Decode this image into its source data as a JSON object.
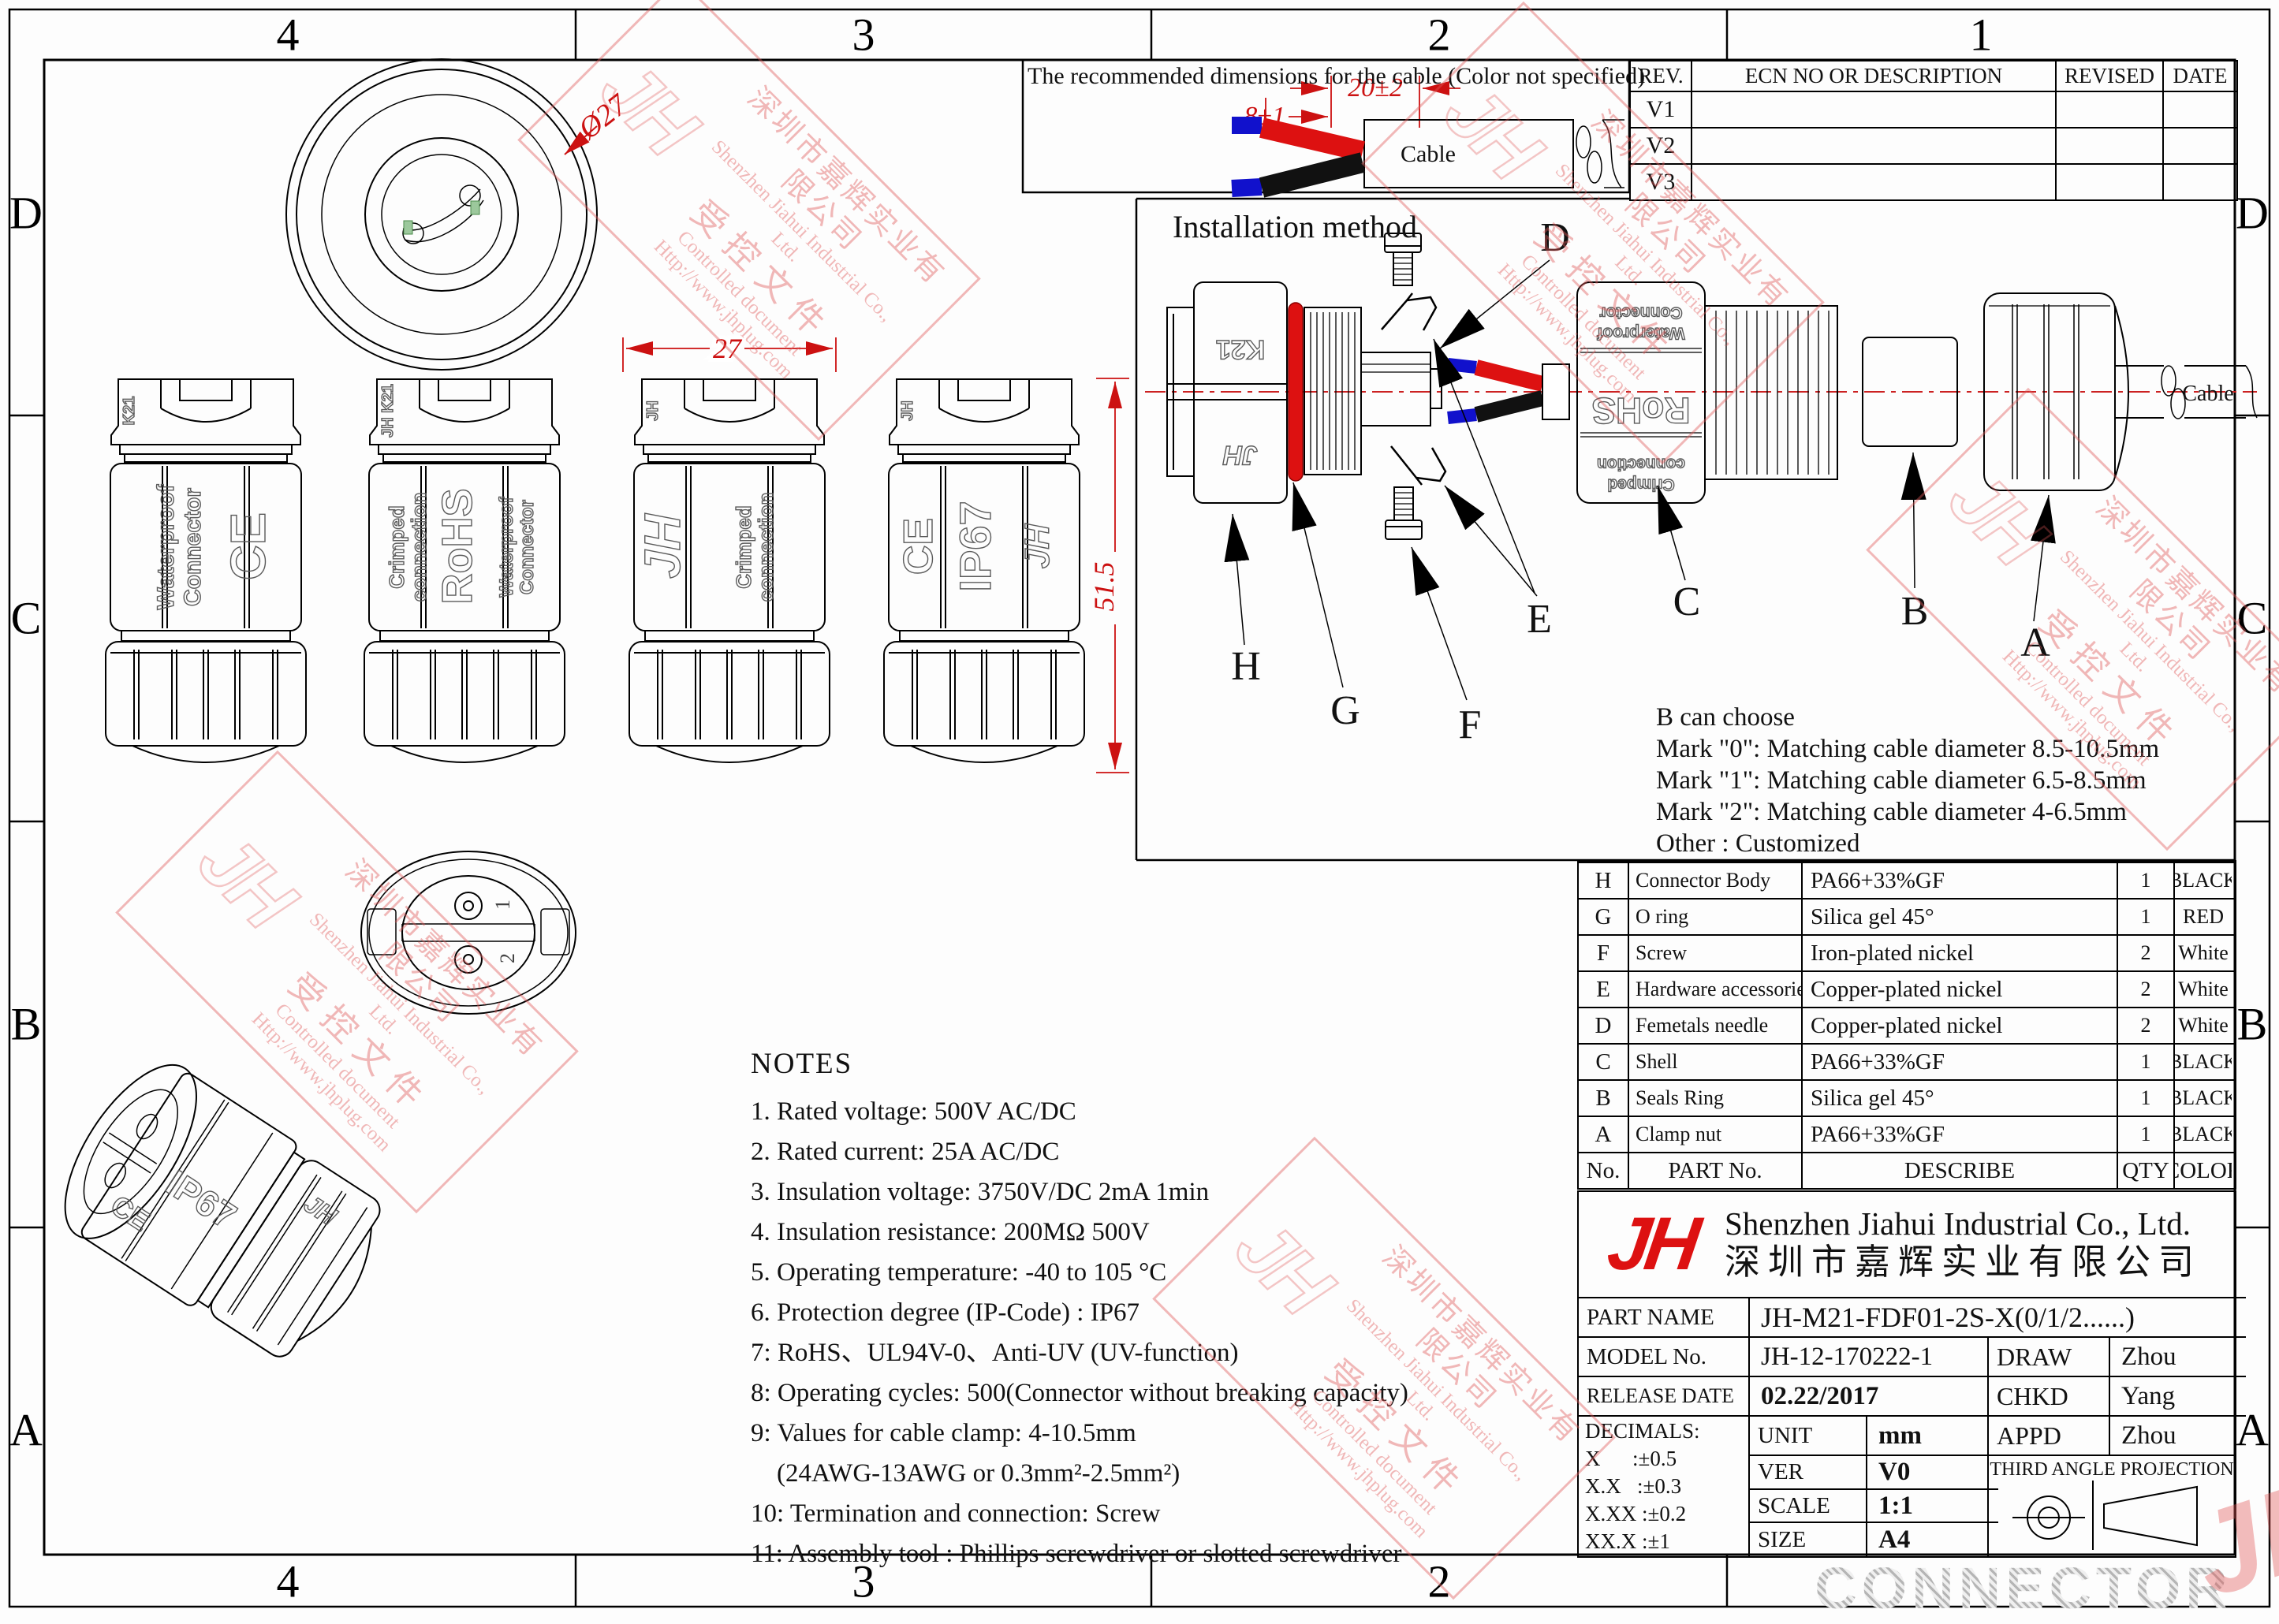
{
  "border": {
    "top": [
      "4",
      "3",
      "2",
      "1"
    ],
    "bottom": [
      "4",
      "3",
      "2"
    ],
    "left": [
      "D",
      "C",
      "B",
      "A"
    ],
    "right": [
      "D",
      "C",
      "B",
      "A"
    ]
  },
  "cable_box": {
    "title": "The recommended dimensions for the cable (Color not specified)",
    "dim_strip": "20±2",
    "dim_tip": "8±1",
    "cable_label": "Cable"
  },
  "revision_table": {
    "headers": [
      "REV.",
      "ECN NO OR DESCRIPTION",
      "REVISED",
      "DATE"
    ],
    "rows": [
      "V1",
      "V2",
      "V3"
    ]
  },
  "dims": {
    "diameter": "Ø27",
    "width": "27",
    "height": "51.5"
  },
  "side_views": {
    "views": [
      {
        "cap": "K21",
        "t1": "Waterproof",
        "t2": "Connector",
        "t3": "CE"
      },
      {
        "cap": "JH K21",
        "t1": "Crimped",
        "t2": "connection",
        "t3": "RoHS",
        "t4": "Waterproof",
        "t5": "Connector"
      },
      {
        "cap": "JH",
        "t1": "JH",
        "t2": "Crimped",
        "t3": "connection"
      },
      {
        "cap": "JH",
        "t1": "CE",
        "t2": "IP67",
        "t3": "JH"
      }
    ]
  },
  "face_view": {
    "pins": [
      "1",
      "2"
    ]
  },
  "iso_view": {
    "labels": [
      "CE",
      "IP67",
      "JH"
    ]
  },
  "installation": {
    "title": "Installation method",
    "callouts": [
      "H",
      "G",
      "F",
      "E",
      "D",
      "C",
      "B",
      "A"
    ],
    "body_marks": [
      "K21",
      "JH"
    ],
    "shell_marks": [
      "Waterproof",
      "Connector",
      "RoHS",
      "Crimped",
      "connection"
    ],
    "cable_label": "Cable"
  },
  "b_choose": {
    "lines": [
      "B can choose",
      "Mark \"0\": Matching cable diameter 8.5-10.5mm",
      "Mark \"1\": Matching cable diameter 6.5-8.5mm",
      "Mark \"2\": Matching cable diameter 4-6.5mm",
      "Other : Customized"
    ]
  },
  "parts_table": {
    "rows": [
      [
        "H",
        "Connector Body",
        "PA66+33%GF",
        "1",
        "BLACK"
      ],
      [
        "G",
        "O ring",
        "Silica gel 45°",
        "1",
        "RED"
      ],
      [
        "F",
        "Screw",
        "Iron-plated nickel",
        "2",
        "White"
      ],
      [
        "E",
        "Hardware accessories",
        "Copper-plated nickel",
        "2",
        "White"
      ],
      [
        "D",
        "Femetals needle",
        "Copper-plated nickel",
        "2",
        "White"
      ],
      [
        "C",
        "Shell",
        "PA66+33%GF",
        "1",
        "BLACK"
      ],
      [
        "B",
        "Seals Ring",
        "Silica gel 45°",
        "1",
        "BLACK"
      ],
      [
        "A",
        "Clamp nut",
        "PA66+33%GF",
        "1",
        "BLACK"
      ],
      [
        "No.",
        "PART No.",
        "DESCRIBE",
        "QTY",
        "COLOR"
      ]
    ]
  },
  "notes": {
    "title": "NOTES",
    "items": [
      "1. Rated voltage: 500V AC/DC",
      "2. Rated current: 25A AC/DC",
      "3. Insulation voltage: 3750V/DC 2mA 1min",
      "4. Insulation resistance: 200MΩ 500V",
      "5. Operating temperature: -40 to 105 °C",
      "6. Protection degree (IP-Code) : IP67",
      "7: RoHS、UL94V-0、Anti-UV (UV-function)",
      "8: Operating cycles: 500(Connector without breaking capacity)",
      "9: Values for cable clamp: 4-10.5mm",
      "    (24AWG-13AWG or 0.3mm²-2.5mm²)",
      "10: Termination and connection: Screw",
      "11: Assembly tool : Phillips screwdriver or slotted screwdriver"
    ]
  },
  "title_block": {
    "logo": "JH",
    "company_en": "Shenzhen Jiahui Industrial Co., Ltd.",
    "company_cn": "深圳市嘉辉实业有限公司",
    "part_name_label": "PART NAME",
    "part_name": "JH-M21-FDF01-2S-X(0/1/2......)",
    "model_label": "MODEL No.",
    "model": "JH-12-170222-1",
    "draw_label": "DRAW",
    "draw": "Zhou",
    "release_label": "RELEASE DATE",
    "release": "02.22/2017",
    "chkd_label": "CHKD",
    "chkd": "Yang",
    "decimals": [
      "DECIMALS:",
      "X      :±0.5",
      "X.X   :±0.3",
      "X.XX :±0.2",
      "XX.X :±1"
    ],
    "unit_label": "UNIT",
    "unit": "mm",
    "appd_label": "APPD",
    "appd": "Zhou",
    "ver_label": "VER",
    "ver": "V0",
    "projection": "THIRD ANGLE PROJECTION",
    "scale_label": "SCALE",
    "scale": "1:1",
    "size_label": "SIZE",
    "size": "A4"
  },
  "watermark": {
    "logo": "JH",
    "cn": "深圳市嘉辉实业有限公司",
    "en": "Shenzhen Jiahui Industrial Co., Ltd.",
    "cn2": "受控文件",
    "en2": "Controlled document",
    "url": "Http://www.jhplug.com"
  },
  "banner": {
    "text": "CONNECTOR"
  }
}
